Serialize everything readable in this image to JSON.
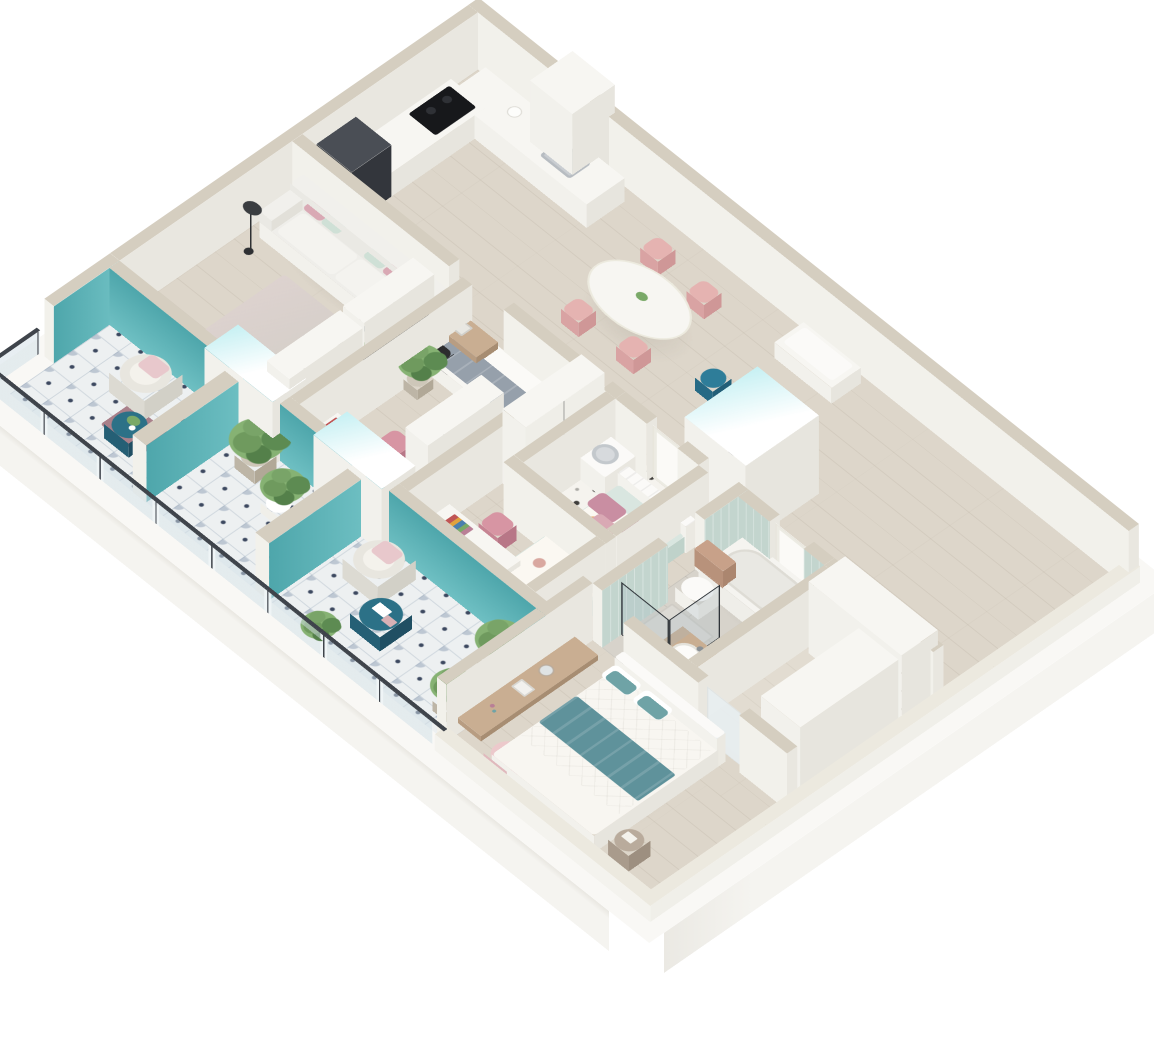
{
  "scene": {
    "title": "3d-apartment-floor-plan",
    "style": "isometric dollhouse render, top-down cutaway, no text labels",
    "background": "#ffffff"
  },
  "palette": {
    "slab_top": "#f9f8f5",
    "slab_side": "#f5f4f0",
    "wall_top": "#d5cec0",
    "wall_top_low": "#ece9df",
    "wall_sw": "#f2f1eb",
    "wall_se": "#e9e7e0",
    "floor_wood": "#ddd6ca",
    "floor_bath": "#d7d3cb",
    "floor_closet": "#e2dcd1",
    "tile_balcony_base": "#edf0f1",
    "tile_balcony_motif": "#96a5b9",
    "tile_balcony_dot": "#3d4960",
    "tile_wc_base": "#f5f3ee",
    "tile_wc_dot": "#3f3e3b",
    "accent_teal": "#58b2b6",
    "accent_teal_dark": "#2c7187",
    "mint_tile": "#c3d5ce",
    "glow_cyan": "#c6f0f3",
    "furn_white_top": "#f7f6f2",
    "furn_white_sw": "#f2f1ec",
    "furn_white_se": "#e7e5de",
    "wood_desk": "#c9ae92",
    "wood_desk_side": "#b89d82",
    "pink_pillow": "#d9a9b4",
    "mauve_pillow": "#b97f96",
    "mint_pillow": "#cfe0d6",
    "pink_chair": "#d795a3",
    "pink_chair_side": "#c68493",
    "dining_chair": "#e5b3b1",
    "gray_daybed": "#96a0ab",
    "teal_blanket": "#5f929b",
    "teal_pillow": "#6fa3a6",
    "pouf_pink": "#ecc9cb",
    "dark_appliance": "#3c4046",
    "tv_screen": "#33383f",
    "plant_green_1": "#5d8b52",
    "plant_green_2": "#7aa968",
    "pot_beige": "#cec7b9",
    "rattan_chair": "#e8e6df",
    "rug_mauve": "#a9808a",
    "railing_frame": "#3f444b",
    "duvet_orange_leaf": "#e8b07c",
    "duvet_green_leaf": "#b0c4a9",
    "shelf_red_box": "#b5483f",
    "shelf_blue_box": "#3b6ea5"
  },
  "rooms": [
    {
      "name": "kitchen",
      "furniture": [
        "l-shaped-counter",
        "sink",
        "faucet",
        "black-cooktop",
        "fridge",
        "tall-cabinet",
        "kettle"
      ]
    },
    {
      "name": "dining-area",
      "furniture": [
        "oval-white-table",
        "pink-chair-1",
        "pink-chair-2",
        "pink-chair-3",
        "pink-chair-4",
        "centerpiece-plant"
      ]
    },
    {
      "name": "entrance-hall",
      "furniture": [
        "white-bench",
        "teal-stool",
        "shoes",
        "built-in-closet-volume"
      ]
    },
    {
      "name": "living-room",
      "furniture": [
        "white-sofa",
        "pink-pillows",
        "mint-pillows",
        "black-floor-lamp",
        "area-rug",
        "wall-tv",
        "floating-shelf",
        "open-bookshelf",
        "two-door-wardrobe",
        "round-coffee-table",
        "white-armchair",
        "desk-nook",
        "black-desk-chair",
        "laptop"
      ]
    },
    {
      "name": "study-bedroom",
      "furniture": [
        "gray-daybed",
        "white-pillow",
        "potted-plant",
        "desk",
        "laptop",
        "books",
        "pink-chair",
        "wardrobe"
      ]
    },
    {
      "name": "kids-bedroom",
      "furniture": [
        "single-bed-floral-duvet",
        "channel-tufted-headboard",
        "pink-pillows",
        "desk",
        "book-row",
        "pink-chair",
        "wardrobe",
        "dark-round-stool"
      ]
    },
    {
      "name": "master-bedroom",
      "furniture": [
        "double-bed",
        "quilted-white-duvet",
        "teal-throw",
        "white-pillows",
        "teal-pillows",
        "headboard",
        "floating-wood-desk",
        "tablet",
        "round-mirror",
        "pink-pouf",
        "round-nightstand"
      ]
    },
    {
      "name": "bathroom",
      "furniture": [
        "bathtub",
        "tub-faucet",
        "black-frame-glass-shower",
        "wall-hung-toilet",
        "wood-cistern-box",
        "wood-vanity",
        "round-basin"
      ]
    },
    {
      "name": "wc-laundry",
      "furniture": [
        "washing-machine",
        "patterned-star-tile-floor"
      ]
    },
    {
      "name": "walk-in-closet",
      "furniture": [
        "open-shelving-unit",
        "red-storage-box",
        "blue-storage-box",
        "tall-white-cabinet",
        "frosted-sliding-door"
      ]
    },
    {
      "name": "balcony-upper",
      "furniture": [
        "rattan-lounge-chair",
        "pink-cushion",
        "mauve-rug",
        "teal-side-table",
        "small-plant",
        "glass-railing",
        "teal-accent-walls"
      ]
    },
    {
      "name": "balcony-middle",
      "furniture": [
        "large-potted-plant",
        "small-potted-plant",
        "glass-railing",
        "teal-accent-walls"
      ]
    },
    {
      "name": "balcony-lower",
      "furniture": [
        "rattan-lounge-chair",
        "pink-cushion",
        "teal-coffee-table",
        "magazines",
        "potted-plant-1",
        "potted-plant-2",
        "patterned-tile-floor",
        "glass-railing",
        "teal-accent-wall"
      ]
    }
  ],
  "glass_door_volumes": [
    "living-to-balcony-door-unit",
    "study-to-balcony-door-unit",
    "entrance-closet-volume"
  ],
  "counts": {
    "rooms": 10,
    "balconies": 3,
    "beds": 3,
    "desks": 4,
    "plants": 8
  }
}
